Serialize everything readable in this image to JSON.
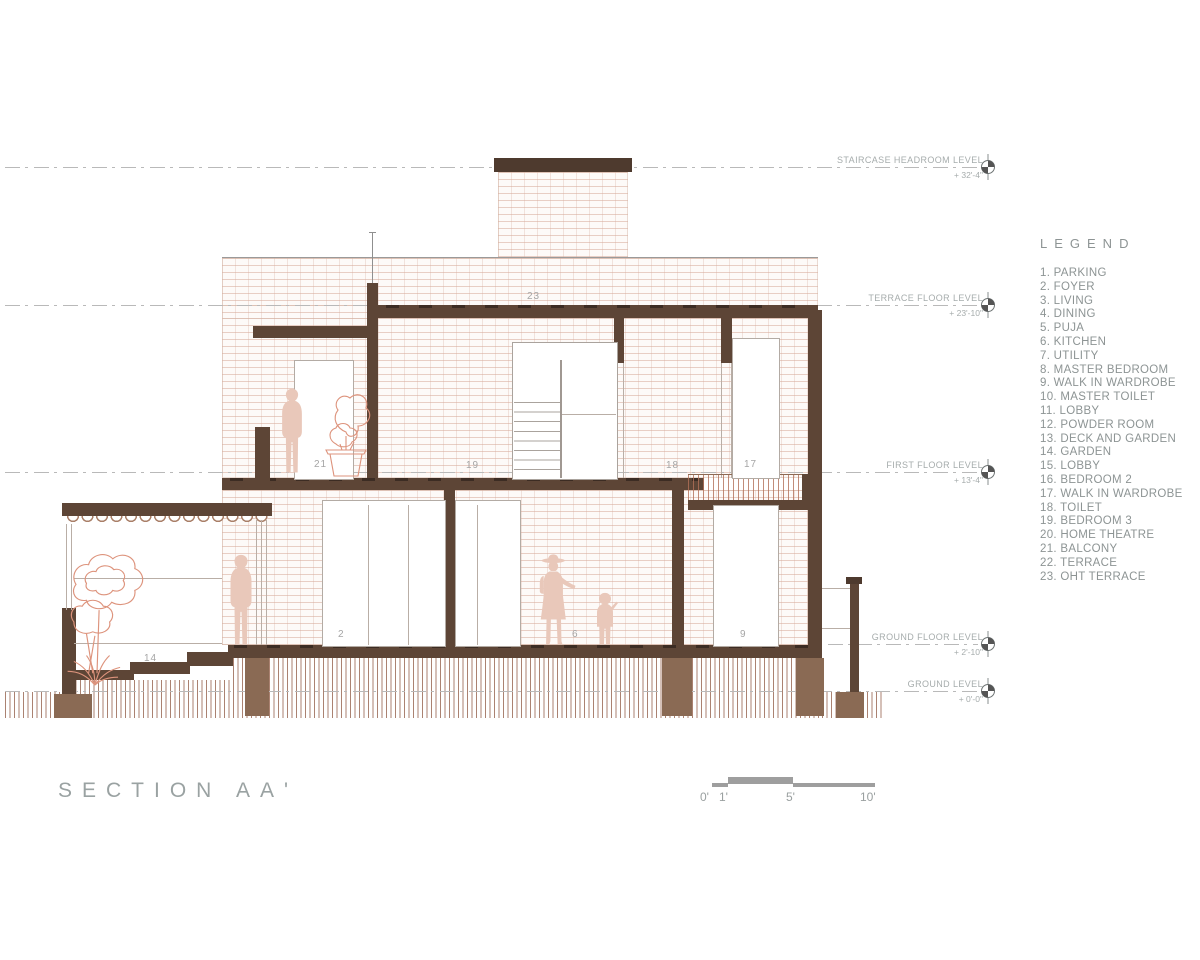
{
  "title": {
    "text": "SECTION AA'"
  },
  "legend": {
    "title": "LEGEND",
    "items": [
      "PARKING",
      "FOYER",
      "LIVING",
      "DINING",
      "PUJA",
      "KITCHEN",
      "UTILITY",
      "MASTER BEDROOM",
      "WALK IN WARDROBE",
      "MASTER TOILET",
      "LOBBY",
      "POWDER ROOM",
      "DECK AND GARDEN",
      "GARDEN",
      "LOBBY",
      "BEDROOM 2",
      "WALK IN WARDROBE",
      "TOILET",
      "BEDROOM 3",
      "HOME THEATRE",
      "BALCONY",
      "TERRACE",
      "OHT TERRACE"
    ]
  },
  "levels": [
    {
      "label": "STAIRCASE HEADROOM LEVEL",
      "value": "+ 32'-4\""
    },
    {
      "label": "TERRACE FLOOR LEVEL",
      "value": "+ 23'-10\""
    },
    {
      "label": "FIRST FLOOR LEVEL",
      "value": "+ 13'-4\""
    },
    {
      "label": "GROUND FLOOR LEVEL",
      "value": "+ 2'-10\""
    },
    {
      "label": "GROUND LEVEL",
      "value": "+ 0'-0\""
    }
  ],
  "room_labels": {
    "oht_terrace": "23",
    "balcony": "21",
    "bedroom3": "19",
    "toilet": "18",
    "walk_in_wardrobe": "17",
    "foyer": "2",
    "kitchen": "6",
    "wardrobe9": "9",
    "garden": "14"
  },
  "scale_bar": {
    "ticks": [
      "0'",
      "1'",
      "5'",
      "10'"
    ]
  },
  "colors": {
    "cut_wall": "#5d4536",
    "footing": "#8a6a54",
    "brick_line": "#d6aa9a",
    "figure": "#e9c8ba",
    "plant_stroke": "#dd937c",
    "annotation_gray": "#9aa0a0"
  }
}
